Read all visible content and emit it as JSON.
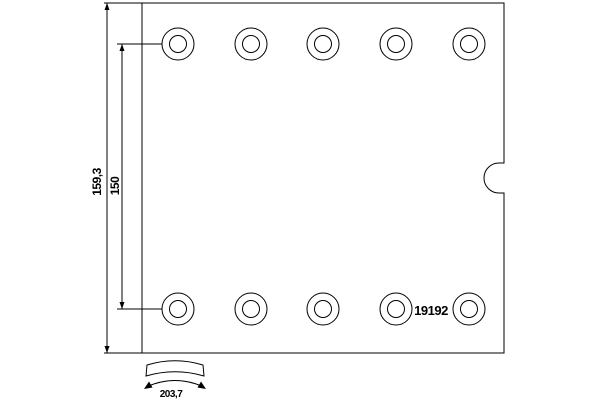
{
  "drawing": {
    "type": "brake-lining-technical-drawing",
    "part_number": "19192",
    "dimensions": {
      "overall_height": "159,3",
      "hole_spacing": "150",
      "arc_width": "203,7"
    },
    "rivet_holes": {
      "rows": 2,
      "holes_per_row": 5,
      "total": 10
    },
    "colors": {
      "line": "#000000",
      "background": "#ffffff"
    }
  }
}
